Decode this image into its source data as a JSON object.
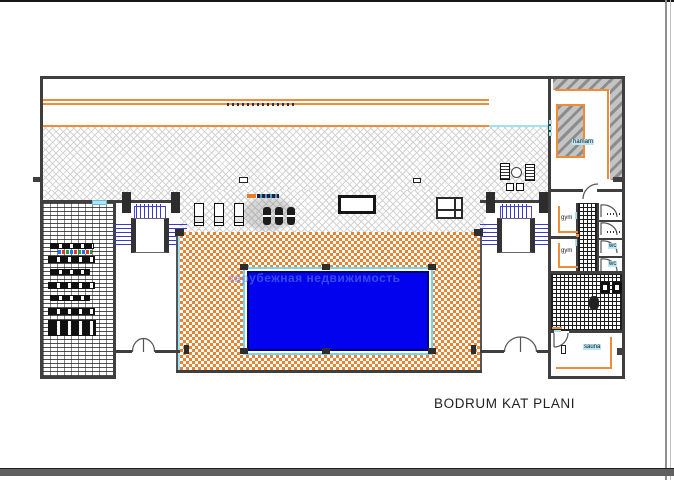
{
  "title": "BODRUM KAT PLANI",
  "watermark": "зарубежная недвижимость",
  "rooms": {
    "hamam": "hamam",
    "gym_upper": "gym",
    "gym_lower": "gym",
    "wc_upper": "wc",
    "wc_lower": "wc",
    "sauna": "sauna"
  },
  "colors": {
    "wall": "#3F3F3F",
    "accent_orange": "#EF8C3A",
    "deck_orange": "#EF8030",
    "pool_blue": "#0202EE",
    "pool_rim_cyan": "#6FD8F0",
    "stair_blue": "#3A3AD0",
    "hatch_gray": "#D2D2D2",
    "watermark_blue": "rgba(100,135,245,0.55)"
  }
}
